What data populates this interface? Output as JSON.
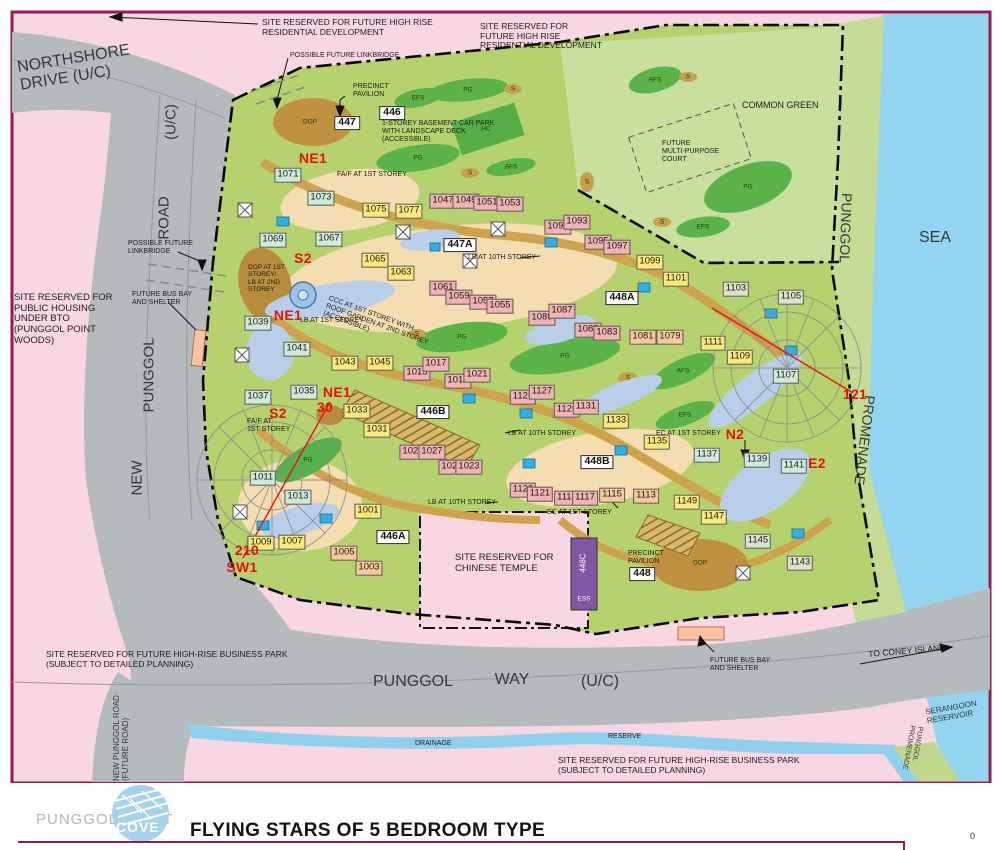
{
  "footer": {
    "brand_left": "PUNGGOL POINT",
    "brand_cove": "COVE",
    "title": "FLYING STARS OF 5 BEDROOM TYPE",
    "page_mark": "0"
  },
  "colors": {
    "frame": "#8e1e52",
    "background_pink": "#f8d7e3",
    "road_gray": "#b5bbbc",
    "site_green": "#b6d26e",
    "common_green": "#c9df9e",
    "promenade_green": "#c6db95",
    "water_blue": "#93d5f1",
    "path_tan": "#cfa24c",
    "dop_brown": "#c0923f",
    "deck_beige": "#f4ddb0",
    "planting_green": "#5cb34a",
    "water_feature_blue": "#b9cfe9",
    "building_teal": "#cfe9da",
    "building_yellow": "#f9e87c",
    "building_pink": "#f1b3b4",
    "building_salmon": "#f6c99c",
    "building_gray": "#dde2cd",
    "ess_purple": "#7e57a5",
    "bus_bay_salmon": "#f9c2a2",
    "flying_star_red": "#e8120c",
    "logo_blue": "#a5d3ee"
  },
  "map": {
    "buildings": [
      {
        "t": "1071",
        "x": 288,
        "y": 175,
        "c": "teal"
      },
      {
        "t": "1073",
        "x": 321,
        "y": 198,
        "c": "teal"
      },
      {
        "t": "1069",
        "x": 273,
        "y": 240,
        "c": "teal"
      },
      {
        "t": "1067",
        "x": 329,
        "y": 239,
        "c": "teal"
      },
      {
        "t": "1039",
        "x": 258,
        "y": 323,
        "c": "teal"
      },
      {
        "t": "1041",
        "x": 297,
        "y": 349,
        "c": "teal"
      },
      {
        "t": "1037",
        "x": 258,
        "y": 397,
        "c": "teal"
      },
      {
        "t": "1035",
        "x": 304,
        "y": 392,
        "c": "teal"
      },
      {
        "t": "1011",
        "x": 263,
        "y": 478,
        "c": "teal"
      },
      {
        "t": "1013",
        "x": 298,
        "y": 497,
        "c": "teal"
      },
      {
        "t": "1107",
        "x": 786,
        "y": 376,
        "c": "teal"
      },
      {
        "t": "1137",
        "x": 707,
        "y": 455,
        "c": "teal"
      },
      {
        "t": "1139",
        "x": 757,
        "y": 460,
        "c": "teal"
      },
      {
        "t": "1141",
        "x": 794,
        "y": 466,
        "c": "teal"
      },
      {
        "t": "1075",
        "x": 376,
        "y": 210,
        "c": "yellow"
      },
      {
        "t": "1077",
        "x": 409,
        "y": 211,
        "c": "yellow"
      },
      {
        "t": "1065",
        "x": 375,
        "y": 260,
        "c": "yellow"
      },
      {
        "t": "1063",
        "x": 401,
        "y": 273,
        "c": "yellow"
      },
      {
        "t": "1043",
        "x": 345,
        "y": 363,
        "c": "yellow"
      },
      {
        "t": "1045",
        "x": 380,
        "y": 363,
        "c": "yellow"
      },
      {
        "t": "1033",
        "x": 357,
        "y": 411,
        "c": "yellow"
      },
      {
        "t": "1031",
        "x": 377,
        "y": 430,
        "c": "yellow"
      },
      {
        "t": "1001",
        "x": 368,
        "y": 511,
        "c": "yellow"
      },
      {
        "t": "1009",
        "x": 261,
        "y": 543,
        "c": "yellow"
      },
      {
        "t": "1007",
        "x": 292,
        "y": 542,
        "c": "yellow"
      },
      {
        "t": "1099",
        "x": 650,
        "y": 262,
        "c": "yellow"
      },
      {
        "t": "1101",
        "x": 676,
        "y": 279,
        "c": "yellow"
      },
      {
        "t": "1111",
        "x": 713,
        "y": 343,
        "c": "yellow"
      },
      {
        "t": "1109",
        "x": 740,
        "y": 357,
        "c": "yellow"
      },
      {
        "t": "1133",
        "x": 616,
        "y": 421,
        "c": "yellow"
      },
      {
        "t": "1135",
        "x": 657,
        "y": 442,
        "c": "yellow"
      },
      {
        "t": "1149",
        "x": 687,
        "y": 502,
        "c": "yellow"
      },
      {
        "t": "1147",
        "x": 714,
        "y": 517,
        "c": "yellow"
      },
      {
        "t": "1047",
        "x": 443,
        "y": 201,
        "c": "pink"
      },
      {
        "t": "1049",
        "x": 466,
        "y": 201,
        "c": "pink"
      },
      {
        "t": "1051",
        "x": 487,
        "y": 203,
        "c": "pink"
      },
      {
        "t": "1053",
        "x": 510,
        "y": 204,
        "c": "pink"
      },
      {
        "t": "1061",
        "x": 443,
        "y": 288,
        "c": "pink"
      },
      {
        "t": "1059",
        "x": 459,
        "y": 297,
        "c": "pink"
      },
      {
        "t": "1057",
        "x": 483,
        "y": 302,
        "c": "pink"
      },
      {
        "t": "1055",
        "x": 500,
        "y": 306,
        "c": "pink"
      },
      {
        "t": "1091",
        "x": 558,
        "y": 227,
        "c": "pink"
      },
      {
        "t": "1093",
        "x": 577,
        "y": 222,
        "c": "pink"
      },
      {
        "t": "1095",
        "x": 598,
        "y": 242,
        "c": "pink"
      },
      {
        "t": "1097",
        "x": 617,
        "y": 247,
        "c": "pink"
      },
      {
        "t": "1089",
        "x": 542,
        "y": 318,
        "c": "pink"
      },
      {
        "t": "1087",
        "x": 562,
        "y": 311,
        "c": "pink"
      },
      {
        "t": "1085",
        "x": 588,
        "y": 330,
        "c": "pink"
      },
      {
        "t": "1083",
        "x": 607,
        "y": 333,
        "c": "pink"
      },
      {
        "t": "1015",
        "x": 417,
        "y": 373,
        "c": "pink"
      },
      {
        "t": "1017",
        "x": 436,
        "y": 364,
        "c": "pink"
      },
      {
        "t": "1019",
        "x": 458,
        "y": 381,
        "c": "pink"
      },
      {
        "t": "1021",
        "x": 477,
        "y": 375,
        "c": "pink"
      },
      {
        "t": "1029",
        "x": 413,
        "y": 452,
        "c": "pink"
      },
      {
        "t": "1027",
        "x": 432,
        "y": 452,
        "c": "pink"
      },
      {
        "t": "1025",
        "x": 452,
        "y": 467,
        "c": "pink"
      },
      {
        "t": "1023",
        "x": 469,
        "y": 467,
        "c": "pink"
      },
      {
        "t": "1125",
        "x": 523,
        "y": 397,
        "c": "pink"
      },
      {
        "t": "1127",
        "x": 542,
        "y": 392,
        "c": "pink"
      },
      {
        "t": "1129",
        "x": 567,
        "y": 410,
        "c": "pink"
      },
      {
        "t": "1131",
        "x": 586,
        "y": 407,
        "c": "pink"
      },
      {
        "t": "1123",
        "x": 523,
        "y": 490,
        "c": "pink"
      },
      {
        "t": "1121",
        "x": 540,
        "y": 494,
        "c": "pink"
      },
      {
        "t": "1119",
        "x": 567,
        "y": 498,
        "c": "pink"
      },
      {
        "t": "1117",
        "x": 585,
        "y": 498,
        "c": "pink"
      },
      {
        "t": "1081",
        "x": 643,
        "y": 337,
        "c": "salmon"
      },
      {
        "t": "1079",
        "x": 670,
        "y": 337,
        "c": "salmon"
      },
      {
        "t": "1005",
        "x": 344,
        "y": 553,
        "c": "salmon"
      },
      {
        "t": "1003",
        "x": 369,
        "y": 568,
        "c": "salmon"
      },
      {
        "t": "1115",
        "x": 612,
        "y": 495,
        "c": "salmon"
      },
      {
        "t": "1113",
        "x": 646,
        "y": 496,
        "c": "salmon"
      },
      {
        "t": "1103",
        "x": 736,
        "y": 289,
        "c": "gray"
      },
      {
        "t": "1105",
        "x": 791,
        "y": 297,
        "c": "gray"
      },
      {
        "t": "1145",
        "x": 758,
        "y": 541,
        "c": "gray"
      },
      {
        "t": "1143",
        "x": 800,
        "y": 563,
        "c": "gray"
      }
    ],
    "idboxes": [
      {
        "t": "447",
        "x": 347,
        "y": 123
      },
      {
        "t": "446",
        "x": 392,
        "y": 113
      },
      {
        "t": "447A",
        "x": 460,
        "y": 245
      },
      {
        "t": "448A",
        "x": 622,
        "y": 298
      },
      {
        "t": "446B",
        "x": 433,
        "y": 412
      },
      {
        "t": "448B",
        "x": 597,
        "y": 462
      },
      {
        "t": "446A",
        "x": 393,
        "y": 537
      },
      {
        "t": "448",
        "x": 642,
        "y": 574
      }
    ],
    "red_labels": [
      {
        "t": "NE1",
        "x": 313,
        "y": 159
      },
      {
        "t": "S2",
        "x": 303,
        "y": 259
      },
      {
        "t": "NE1",
        "x": 288,
        "y": 316
      },
      {
        "t": "NE1",
        "x": 337,
        "y": 393
      },
      {
        "t": "30",
        "x": 325,
        "y": 408
      },
      {
        "t": "S2",
        "x": 278,
        "y": 414
      },
      {
        "t": "210",
        "x": 247,
        "y": 551
      },
      {
        "t": "SW1",
        "x": 242,
        "y": 568
      },
      {
        "t": "N2",
        "x": 735,
        "y": 435
      },
      {
        "t": "E2",
        "x": 817,
        "y": 464
      },
      {
        "t": "121",
        "x": 855,
        "y": 395
      }
    ],
    "notes": [
      {
        "t": "SITE RESERVED FOR FUTURE HIGH RISE\nRESIDENTIAL DEVELOPMENT",
        "x": 262,
        "y": 18,
        "fs": 8.5
      },
      {
        "t": "SITE RESERVED FOR\nFUTURE HIGH RISE\nRESIDENTIAL DEVELOPMENT",
        "x": 480,
        "y": 22,
        "fs": 8.5
      },
      {
        "t": "POSSIBLE FUTURE LINKBRIDGE",
        "x": 290,
        "y": 52
      },
      {
        "t": "PRECINCT\nPAVILION",
        "x": 353,
        "y": 83
      },
      {
        "t": "1-STOREY BASEMENT CAR PARK\nWITH LANDSCAPE DECK\n(ACCESSIBLE)",
        "x": 382,
        "y": 120
      },
      {
        "t": "FA/F AT 1ST STOREY",
        "x": 337,
        "y": 171
      },
      {
        "t": "POSSIBLE FUTURE\nLINKBRIDGE",
        "x": 128,
        "y": 240
      },
      {
        "t": "SITE RESERVED FOR\nPUBLIC HOUSING\nUNDER BTO\n(PUNGGOL POINT\nWOODS)",
        "x": 14,
        "y": 293,
        "fs": 9.5
      },
      {
        "t": "FUTURE BUS BAY\nAND SHELTER",
        "x": 132,
        "y": 291
      },
      {
        "t": "DOP AT 1ST\nSTOREY/\nLB AT 2ND\nSTOREY",
        "x": 248,
        "y": 264,
        "fs": 6.5
      },
      {
        "t": "LB AT 1ST STOREY",
        "x": 300,
        "y": 317
      },
      {
        "t": "CCC AT 1ST STOREY WITH\nROOF GARDEN AT 2ND STOREY\n(ACCESSIBLE)",
        "x": 330,
        "y": 295,
        "rot": 20
      },
      {
        "t": "LB AT 10TH STOREY",
        "x": 468,
        "y": 254
      },
      {
        "t": "FA/F AT\n1ST STOREY",
        "x": 247,
        "y": 418
      },
      {
        "t": "LB AT 10TH STOREY",
        "x": 508,
        "y": 430
      },
      {
        "t": "LB AT 10TH STOREY",
        "x": 428,
        "y": 499
      },
      {
        "t": "EC AT 1ST STOREY",
        "x": 547,
        "y": 509
      },
      {
        "t": "EC AT 1ST STOREY",
        "x": 656,
        "y": 430
      },
      {
        "t": "COMMON GREEN",
        "x": 742,
        "y": 100,
        "fs": 9
      },
      {
        "t": "FUTURE\nMULTI-PURPOSE\nCOURT",
        "x": 662,
        "y": 140
      },
      {
        "t": "SITE RESERVED FOR\nCHINESE TEMPLE",
        "x": 455,
        "y": 553,
        "fs": 9.5
      },
      {
        "t": "PRECINCT\nPAVILION",
        "x": 628,
        "y": 550
      },
      {
        "t": "FUTURE BUS BAY\nAND SHELTER",
        "x": 710,
        "y": 657
      },
      {
        "t": "SITE RESERVED FOR FUTURE HIGH-RISE BUSINESS PARK\n(SUBJECT TO DETAILED PLANNING)",
        "x": 46,
        "y": 650,
        "fs": 8.5
      },
      {
        "t": "SITE RESERVED FOR FUTURE HIGH-RISE BUSINESS PARK\n(SUBJECT TO DETAILED PLANNING)",
        "x": 558,
        "y": 756,
        "fs": 8.5
      },
      {
        "t": "DRAINAGE",
        "x": 415,
        "y": 740
      },
      {
        "t": "RESERVE",
        "x": 608,
        "y": 733
      },
      {
        "t": "TO CONEY ISLAND",
        "x": 868,
        "y": 650,
        "fs": 8.5,
        "rot": -5
      }
    ],
    "area_labels": [
      {
        "t": "EFS",
        "x": 418,
        "y": 98
      },
      {
        "t": "PG",
        "x": 468,
        "y": 90
      },
      {
        "t": "S",
        "x": 513,
        "y": 89
      },
      {
        "t": "HC",
        "x": 486,
        "y": 129
      },
      {
        "t": "PG",
        "x": 418,
        "y": 158
      },
      {
        "t": "AFS",
        "x": 511,
        "y": 167
      },
      {
        "t": "S",
        "x": 470,
        "y": 173
      },
      {
        "t": "AFS",
        "x": 655,
        "y": 80
      },
      {
        "t": "S",
        "x": 688,
        "y": 77
      },
      {
        "t": "PG",
        "x": 748,
        "y": 187
      },
      {
        "t": "EFS",
        "x": 703,
        "y": 227
      },
      {
        "t": "S",
        "x": 662,
        "y": 222
      },
      {
        "t": "S",
        "x": 587,
        "y": 182
      },
      {
        "t": "PG",
        "x": 565,
        "y": 356
      },
      {
        "t": "S",
        "x": 628,
        "y": 378
      },
      {
        "t": "AFS",
        "x": 683,
        "y": 371
      },
      {
        "t": "EFS",
        "x": 685,
        "y": 415
      },
      {
        "t": "S",
        "x": 417,
        "y": 334
      },
      {
        "t": "PG",
        "x": 462,
        "y": 337
      },
      {
        "t": "PG",
        "x": 308,
        "y": 460
      },
      {
        "t": "DOP",
        "x": 310,
        "y": 122
      },
      {
        "t": "DOP",
        "x": 700,
        "y": 563
      },
      {
        "t": "448C",
        "x": 584,
        "y": 563,
        "rot": -90,
        "c": "wht",
        "fs": 8
      },
      {
        "t": "ESS",
        "x": 584,
        "y": 599,
        "c": "wht"
      }
    ],
    "road_labels": [
      {
        "t": "NORTHSHORE\nDRIVE (U/C)",
        "x": 75,
        "y": 68,
        "fs": 16,
        "rot": -9
      },
      {
        "t": "(U/C)",
        "x": 172,
        "y": 122,
        "fs": 15,
        "rot": -90
      },
      {
        "t": "ROAD",
        "x": 165,
        "y": 218,
        "fs": 15,
        "rot": -90
      },
      {
        "t": "PUNGGOL",
        "x": 150,
        "y": 375,
        "fs": 15,
        "rot": -90
      },
      {
        "t": "NEW",
        "x": 138,
        "y": 478,
        "fs": 15,
        "rot": -90
      },
      {
        "t": "NEW PUNGGOL ROAD\n(FUTURE ROAD)",
        "x": 122,
        "y": 738,
        "fs": 8,
        "rot": -90
      },
      {
        "t": "PUNGGOL",
        "x": 413,
        "y": 682,
        "fs": 16
      },
      {
        "t": "WAY",
        "x": 512,
        "y": 680,
        "fs": 16
      },
      {
        "t": "(U/C)",
        "x": 600,
        "y": 682,
        "fs": 16
      },
      {
        "t": "SEA",
        "x": 935,
        "y": 238,
        "fs": 16
      },
      {
        "t": "PUNGGOL",
        "x": 845,
        "y": 228,
        "fs": 14,
        "rot": 92
      },
      {
        "t": "PROMENADE",
        "x": 864,
        "y": 440,
        "fs": 14,
        "rot": 97
      },
      {
        "t": "SERANGOON\nRESERVOIR",
        "x": 952,
        "y": 713,
        "fs": 8,
        "rot": -10
      },
      {
        "t": "PUNGGOL\nPROMENADE",
        "x": 912,
        "y": 748,
        "fs": 7,
        "rot": 100
      }
    ]
  }
}
